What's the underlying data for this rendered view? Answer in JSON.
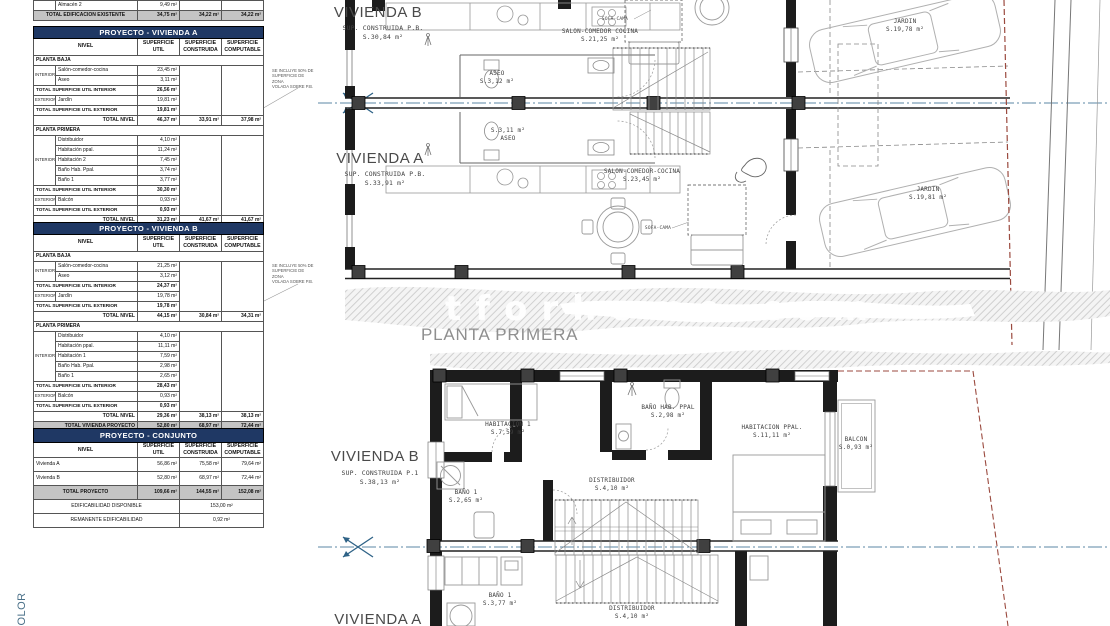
{
  "colors": {
    "table_header_bg": "#1f3864",
    "table_header_text": "#ffffff",
    "total_row_bg": "#c4c4c4",
    "section_line_blue": "#5b87a6",
    "boundary_red": "#9b4a3f",
    "hatch_gray": "#cccccc"
  },
  "notes": {
    "volada_note": "SE INCLUYE 50% DE\nSUPERFICIE DE ZONA\nVOLADA SOBRE P.B."
  },
  "plan": {
    "watermark": "tforhome.com",
    "planta_primera": "PLANTA PRIMERA",
    "color_label": "COLOR"
  },
  "tables": {
    "existente": {
      "col_widths": [
        22,
        82,
        42,
        42,
        42
      ],
      "rows": [
        {
          "cells": [
            {
              "t": "",
              "cls": "grp"
            },
            {
              "t": "Almacén 2",
              "cls": "name"
            },
            {
              "t": "9,49 m²",
              "cls": "val"
            },
            {
              "t": ""
            },
            {
              "t": ""
            }
          ]
        },
        {
          "cls": "grand",
          "cells": [
            {
              "t": "TOTAL EDIFICACION EXISTENTE",
              "cs": 2,
              "cls": "tc b"
            },
            {
              "t": "34,75 m²",
              "cls": "val b"
            },
            {
              "t": "34,22 m²",
              "cls": "val b"
            },
            {
              "t": "34,22 m²",
              "cls": "val b"
            }
          ]
        }
      ]
    },
    "vivienda_a": {
      "col_widths": [
        22,
        82,
        42,
        42,
        42
      ],
      "rows": [
        {
          "cls": "titlerow",
          "cells": [
            {
              "t": "PROYECTO - VIVIENDA A",
              "cs": 5
            }
          ]
        },
        {
          "cls": "colhead",
          "cells": [
            {
              "t": "NIVEL",
              "cs": 2
            },
            {
              "t": "SUPERFICIE\nUTIL"
            },
            {
              "t": "SUPERFICIE\nCONSTRUIDA"
            },
            {
              "t": "SUPERFICIE\nCOMPUTABLE"
            }
          ]
        },
        {
          "cells": [
            {
              "t": "PLANTA BAJA",
              "cs": 5,
              "cls": "sec"
            }
          ]
        },
        {
          "cells": [
            {
              "t": "INTERIOR",
              "rs": 2,
              "cls": "grp"
            },
            {
              "t": "Salón-comedor-cocina",
              "cls": "name"
            },
            {
              "t": "23,45 m²",
              "cls": "val"
            },
            {
              "t": "",
              "rs": 5
            },
            {
              "t": "",
              "rs": 5
            }
          ]
        },
        {
          "cells": [
            {
              "t": "Aseo",
              "cls": "name"
            },
            {
              "t": "3,11 m²",
              "cls": "val"
            }
          ]
        },
        {
          "cells": [
            {
              "t": "TOTAL SUPERFICIE UTIL INTERIOR",
              "cs": 2,
              "cls": "tl"
            },
            {
              "t": "26,56 m²",
              "cls": "val b"
            }
          ]
        },
        {
          "cells": [
            {
              "t": "EXTERIOR",
              "cls": "grp"
            },
            {
              "t": "Jardín",
              "cls": "name"
            },
            {
              "t": "19,81 m²",
              "cls": "val"
            }
          ]
        },
        {
          "cells": [
            {
              "t": "TOTAL SUPERFICIE UTIL EXTERIOR",
              "cs": 2,
              "cls": "tl"
            },
            {
              "t": "19,81 m²",
              "cls": "val b"
            }
          ]
        },
        {
          "cells": [
            {
              "t": "TOTAL NIVEL",
              "cs": 2,
              "cls": "tr"
            },
            {
              "t": "46,37 m²",
              "cls": "val b"
            },
            {
              "t": "33,91 m²",
              "cls": "val b"
            },
            {
              "t": "37,98 m²",
              "cls": "val b"
            }
          ]
        },
        {
          "cells": [
            {
              "t": "PLANTA PRIMERA",
              "cs": 5,
              "cls": "sec"
            }
          ]
        },
        {
          "cells": [
            {
              "t": "INTERIOR",
              "rs": 5,
              "cls": "grp"
            },
            {
              "t": "Distribuidor",
              "cls": "name"
            },
            {
              "t": "4,10 m²",
              "cls": "val"
            },
            {
              "t": "",
              "rs": 8
            },
            {
              "t": "",
              "rs": 8
            }
          ]
        },
        {
          "cells": [
            {
              "t": "Habitación ppal.",
              "cls": "name"
            },
            {
              "t": "11,24 m²",
              "cls": "val"
            }
          ]
        },
        {
          "cells": [
            {
              "t": "Habitación 2",
              "cls": "name"
            },
            {
              "t": "7,45 m²",
              "cls": "val"
            }
          ]
        },
        {
          "cells": [
            {
              "t": "Baño Hab. Ppal.",
              "cls": "name"
            },
            {
              "t": "3,74 m²",
              "cls": "val"
            }
          ]
        },
        {
          "cells": [
            {
              "t": "Baño 1",
              "cls": "name"
            },
            {
              "t": "3,77 m²",
              "cls": "val"
            }
          ]
        },
        {
          "cells": [
            {
              "t": "TOTAL SUPERFICIE UTIL INTERIOR",
              "cs": 2,
              "cls": "tl"
            },
            {
              "t": "30,30 m²",
              "cls": "val b"
            }
          ]
        },
        {
          "cells": [
            {
              "t": "EXTERIOR",
              "cls": "grp"
            },
            {
              "t": "Balcón",
              "cls": "name"
            },
            {
              "t": "0,93 m²",
              "cls": "val"
            }
          ]
        },
        {
          "cells": [
            {
              "t": "TOTAL SUPERFICIE UTIL EXTERIOR",
              "cs": 2,
              "cls": "tl"
            },
            {
              "t": "0,93 m²",
              "cls": "val b"
            }
          ]
        },
        {
          "cells": [
            {
              "t": "TOTAL NIVEL",
              "cs": 2,
              "cls": "tr"
            },
            {
              "t": "31,23 m²",
              "cls": "val b"
            },
            {
              "t": "41,67 m²",
              "cls": "val b"
            },
            {
              "t": "41,67 m²",
              "cls": "val b"
            }
          ]
        },
        {
          "cls": "grand",
          "cells": [
            {
              "t": "TOTAL VIVIENDA PROYECTO",
              "cs": 2,
              "cls": "tr"
            },
            {
              "t": "56,86 m²",
              "cls": "val b"
            },
            {
              "t": "75,58 m²",
              "cls": "val b"
            },
            {
              "t": "79,64 m²",
              "cls": "val b"
            }
          ]
        }
      ]
    },
    "vivienda_b": {
      "col_widths": [
        22,
        82,
        42,
        42,
        42
      ],
      "rows": [
        {
          "cls": "titlerow",
          "cells": [
            {
              "t": "PROYECTO - VIVIENDA B",
              "cs": 5
            }
          ]
        },
        {
          "cls": "colhead",
          "cells": [
            {
              "t": "NIVEL",
              "cs": 2
            },
            {
              "t": "SUPERFICIE\nUTIL"
            },
            {
              "t": "SUPERFICIE\nCONSTRUIDA"
            },
            {
              "t": "SUPERFICIE\nCOMPUTABLE"
            }
          ]
        },
        {
          "cells": [
            {
              "t": "PLANTA BAJA",
              "cs": 5,
              "cls": "sec"
            }
          ]
        },
        {
          "cells": [
            {
              "t": "INTERIOR",
              "rs": 2,
              "cls": "grp"
            },
            {
              "t": "Salón-comedor-cocina",
              "cls": "name"
            },
            {
              "t": "21,25 m²",
              "cls": "val"
            },
            {
              "t": "",
              "rs": 5
            },
            {
              "t": "",
              "rs": 5
            }
          ]
        },
        {
          "cells": [
            {
              "t": "Aseo",
              "cls": "name"
            },
            {
              "t": "3,12 m²",
              "cls": "val"
            }
          ]
        },
        {
          "cells": [
            {
              "t": "TOTAL SUPERFICIE UTIL INTERIOR",
              "cs": 2,
              "cls": "tl"
            },
            {
              "t": "24,37 m²",
              "cls": "val b"
            }
          ]
        },
        {
          "cells": [
            {
              "t": "EXTERIOR",
              "cls": "grp"
            },
            {
              "t": "Jardín",
              "cls": "name"
            },
            {
              "t": "19,78 m²",
              "cls": "val"
            }
          ]
        },
        {
          "cells": [
            {
              "t": "TOTAL SUPERFICIE UTIL EXTERIOR",
              "cs": 2,
              "cls": "tl"
            },
            {
              "t": "19,78 m²",
              "cls": "val b"
            }
          ]
        },
        {
          "cells": [
            {
              "t": "TOTAL NIVEL",
              "cs": 2,
              "cls": "tr"
            },
            {
              "t": "44,15 m²",
              "cls": "val b"
            },
            {
              "t": "30,84 m²",
              "cls": "val b"
            },
            {
              "t": "34,31 m²",
              "cls": "val b"
            }
          ]
        },
        {
          "cells": [
            {
              "t": "PLANTA PRIMERA",
              "cs": 5,
              "cls": "sec"
            }
          ]
        },
        {
          "cells": [
            {
              "t": "INTERIOR",
              "rs": 5,
              "cls": "grp"
            },
            {
              "t": "Distribuidor",
              "cls": "name"
            },
            {
              "t": "4,10 m²",
              "cls": "val"
            },
            {
              "t": "",
              "rs": 8
            },
            {
              "t": "",
              "rs": 8
            }
          ]
        },
        {
          "cells": [
            {
              "t": "Habitación ppal.",
              "cls": "name"
            },
            {
              "t": "11,11 m²",
              "cls": "val"
            }
          ]
        },
        {
          "cells": [
            {
              "t": "Habitación 1",
              "cls": "name"
            },
            {
              "t": "7,59 m²",
              "cls": "val"
            }
          ]
        },
        {
          "cells": [
            {
              "t": "Baño Hab. Ppal.",
              "cls": "name"
            },
            {
              "t": "2,98 m²",
              "cls": "val"
            }
          ]
        },
        {
          "cells": [
            {
              "t": "Baño 1",
              "cls": "name"
            },
            {
              "t": "2,65 m²",
              "cls": "val"
            }
          ]
        },
        {
          "cells": [
            {
              "t": "TOTAL SUPERFICIE UTIL INTERIOR",
              "cs": 2,
              "cls": "tl"
            },
            {
              "t": "28,43 m²",
              "cls": "val b"
            }
          ]
        },
        {
          "cells": [
            {
              "t": "EXTERIOR",
              "cls": "grp"
            },
            {
              "t": "Balcón",
              "cls": "name"
            },
            {
              "t": "0,93 m²",
              "cls": "val"
            }
          ]
        },
        {
          "cells": [
            {
              "t": "TOTAL SUPERFICIE UTIL EXTERIOR",
              "cs": 2,
              "cls": "tl"
            },
            {
              "t": "0,93 m²",
              "cls": "val b"
            }
          ]
        },
        {
          "cells": [
            {
              "t": "TOTAL NIVEL",
              "cs": 2,
              "cls": "tr"
            },
            {
              "t": "29,36 m²",
              "cls": "val b"
            },
            {
              "t": "38,13 m²",
              "cls": "val b"
            },
            {
              "t": "38,13 m²",
              "cls": "val b"
            }
          ]
        },
        {
          "cls": "grand",
          "cells": [
            {
              "t": "TOTAL VIVIENDA PROYECTO",
              "cs": 2,
              "cls": "tr"
            },
            {
              "t": "52,80 m²",
              "cls": "val b"
            },
            {
              "t": "68,97 m²",
              "cls": "val b"
            },
            {
              "t": "72,44 m²",
              "cls": "val b"
            }
          ]
        }
      ]
    },
    "conjunto": {
      "cls": "tall",
      "col_widths": [
        22,
        82,
        42,
        42,
        42
      ],
      "rows": [
        {
          "cls": "titlerow",
          "cells": [
            {
              "t": "PROYECTO - CONJUNTO",
              "cs": 5
            }
          ]
        },
        {
          "cls": "colhead",
          "cells": [
            {
              "t": "NIVEL",
              "cs": 2
            },
            {
              "t": "SUPERFICIE\nUTIL"
            },
            {
              "t": "SUPERFICIE\nCONSTRUIDA"
            },
            {
              "t": "SUPERFICIE\nCOMPUTABLE"
            }
          ]
        },
        {
          "cells": [
            {
              "t": "Vivienda A",
              "cs": 2,
              "cls": "name"
            },
            {
              "t": "56,86 m²",
              "cls": "val"
            },
            {
              "t": "75,58 m²",
              "cls": "val"
            },
            {
              "t": "79,64 m²",
              "cls": "val"
            }
          ]
        },
        {
          "cells": [
            {
              "t": "Vivienda B",
              "cs": 2,
              "cls": "name"
            },
            {
              "t": "52,80 m²",
              "cls": "val"
            },
            {
              "t": "68,97 m²",
              "cls": "val"
            },
            {
              "t": "72,44 m²",
              "cls": "val"
            }
          ]
        },
        {
          "cls": "grand",
          "cells": [
            {
              "t": "TOTAL PROYECTO",
              "cs": 2,
              "cls": "tc b"
            },
            {
              "t": "109,66 m²",
              "cls": "val b"
            },
            {
              "t": "144,55 m²",
              "cls": "val b"
            },
            {
              "t": "152,08 m²",
              "cls": "val b"
            }
          ]
        },
        {
          "cells": [
            {
              "t": "EDIFICABILIDAD DISPONIBLE",
              "cs": 3,
              "cls": "tc"
            },
            {
              "t": "153,00 m²",
              "cs": 2,
              "cls": "tc"
            }
          ]
        },
        {
          "cells": [
            {
              "t": "REMANENTE EDIFICABILIDAD",
              "cs": 3,
              "cls": "tc"
            },
            {
              "t": "0,92 m²",
              "cs": 2,
              "cls": "tc"
            }
          ]
        }
      ]
    }
  },
  "plan_labels": [
    {
      "x": 378,
      "y": 3,
      "cls": "title",
      "name": "vivienda-b-title-pb",
      "t": "VIVIENDA B"
    },
    {
      "x": 383,
      "y": 24,
      "cls": "sub",
      "name": "vivienda-b-sup-pb",
      "t": "SUP. CONSTRUIDA P.B.\nS.30,84  m²"
    },
    {
      "x": 380,
      "y": 149,
      "cls": "title",
      "name": "vivienda-a-title-pb",
      "t": "VIVIENDA A"
    },
    {
      "x": 385,
      "y": 170,
      "cls": "sub",
      "name": "vivienda-a-sup-pb",
      "t": "SUP. CONSTRUIDA P.B.\nS.33,91  m²"
    },
    {
      "x": 375,
      "y": 447,
      "cls": "title",
      "name": "vivienda-b-title-p1",
      "t": "VIVIENDA B"
    },
    {
      "x": 380,
      "y": 469,
      "cls": "sub",
      "name": "vivienda-b-sup-p1",
      "t": "SUP. CONSTRUIDA P.1\nS.38,13  m²"
    },
    {
      "x": 378,
      "y": 610,
      "cls": "title",
      "name": "vivienda-a-title-p1",
      "t": "VIVIENDA A"
    },
    {
      "x": 600,
      "y": 28,
      "name": "room-salon-b",
      "t": "SALON-COMEDOR COCINA\nS.21,25  m²"
    },
    {
      "x": 497,
      "y": 70,
      "name": "room-aseo-b",
      "t": "ASEO\nS.3,12  m²"
    },
    {
      "x": 508,
      "y": 127,
      "name": "room-aseo-a",
      "t": "S.3,11  m²\nASEO"
    },
    {
      "x": 642,
      "y": 168,
      "name": "room-salon-a",
      "t": "SALON-COMEDOR-COCINA\nS.23,45  m²"
    },
    {
      "x": 615,
      "y": 17,
      "cls": "tiny",
      "name": "sofa-cama-b",
      "t": "SOFA-CAMA"
    },
    {
      "x": 658,
      "y": 226,
      "cls": "tiny",
      "name": "sofa-cama-a",
      "t": "SOFA-CAMA"
    },
    {
      "x": 905,
      "y": 18,
      "name": "room-jardin-b",
      "t": "JARDIN\nS.19,78  m²"
    },
    {
      "x": 928,
      "y": 186,
      "name": "room-jardin-a",
      "t": "JARDIN\nS.19,81  m²"
    },
    {
      "x": 508,
      "y": 421,
      "name": "room-habitacion-1",
      "t": "HABITACION 1\nS.7,59  m²"
    },
    {
      "x": 668,
      "y": 404,
      "name": "room-bano-hab-ppal",
      "t": "BAÑO HAB. PPAL\nS.2,98  m²"
    },
    {
      "x": 772,
      "y": 424,
      "name": "room-habitacion-ppal",
      "t": "HABITACION PPAL.\nS.11,11  m²"
    },
    {
      "x": 856,
      "y": 436,
      "name": "room-balcon",
      "t": "BALCON\nS.0,93  m²"
    },
    {
      "x": 612,
      "y": 477,
      "name": "room-distribuidor-b",
      "t": "DISTRIBUIDOR\nS.4,10  m²"
    },
    {
      "x": 466,
      "y": 489,
      "name": "room-bano-1-b",
      "t": "BAÑO 1\nS.2,65  m²"
    },
    {
      "x": 500,
      "y": 592,
      "name": "room-bano-1-a",
      "t": "BAÑO 1\nS.3,77  m²"
    },
    {
      "x": 632,
      "y": 605,
      "name": "room-distribuidor-a",
      "t": "DISTRIBUIDOR\nS.4,10  m²"
    }
  ]
}
